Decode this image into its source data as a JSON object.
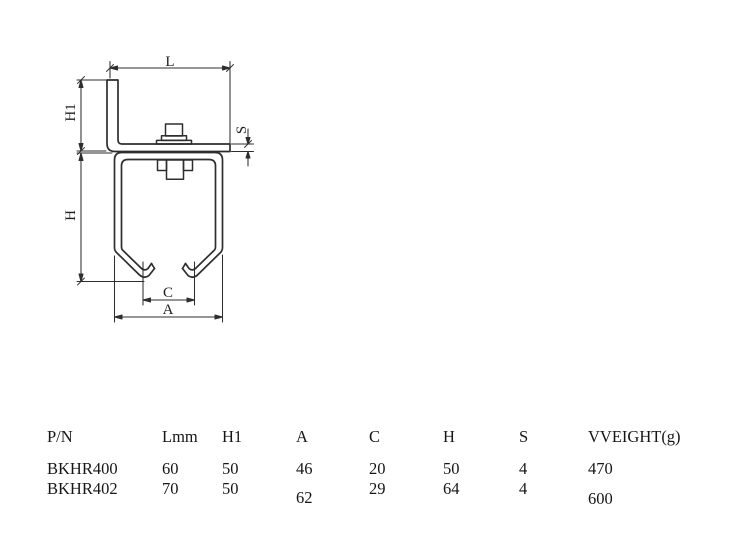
{
  "drawing": {
    "labels": {
      "L": "L",
      "H1": "H1",
      "S": "S",
      "H": "H",
      "C": "C",
      "A": "A"
    }
  },
  "table": {
    "headers": [
      "P/N",
      "Lmm",
      "H1",
      "A",
      "C",
      "H",
      "S",
      "VVEIGHT(g)"
    ],
    "rows": [
      {
        "cells": [
          "BKHR400",
          "60",
          "50",
          "46",
          "20",
          "50",
          "4",
          "470"
        ]
      },
      {
        "cells": [
          "BKHR402",
          "70",
          "50",
          "62",
          "29",
          "64",
          "4",
          "600"
        ]
      }
    ]
  },
  "colors": {
    "background": "#ffffff",
    "line": "#2e2e2e",
    "text": "#161616"
  }
}
